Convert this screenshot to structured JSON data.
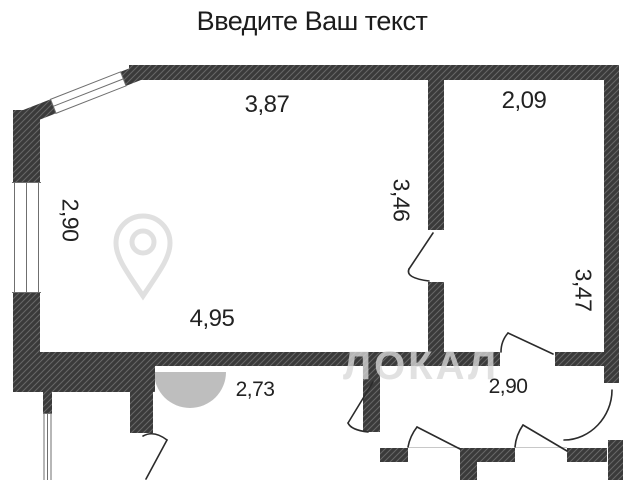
{
  "title": "Введите Ваш текст",
  "watermark": {
    "text": "ЛОКАЛ"
  },
  "dimensions": {
    "living_room_top": "3,87",
    "living_room_left": "2,90",
    "living_room_right": "3,46",
    "living_room_bottom": "4,95",
    "right_room_top": "2,09",
    "right_room_right": "3,47",
    "hallway_left": "2,73",
    "hallway_right": "2,90"
  },
  "colors": {
    "background": "#ffffff",
    "wall_fill": "#3a3a3a",
    "wall_hatch_line": "#676767",
    "window_line": "#6f6f6f",
    "door_line": "#2b2b2b",
    "threshold_line": "#c8c8c8",
    "label_text": "#222222",
    "title_text": "#1c1c1c",
    "watermark_gray": "#d8d8d8"
  }
}
